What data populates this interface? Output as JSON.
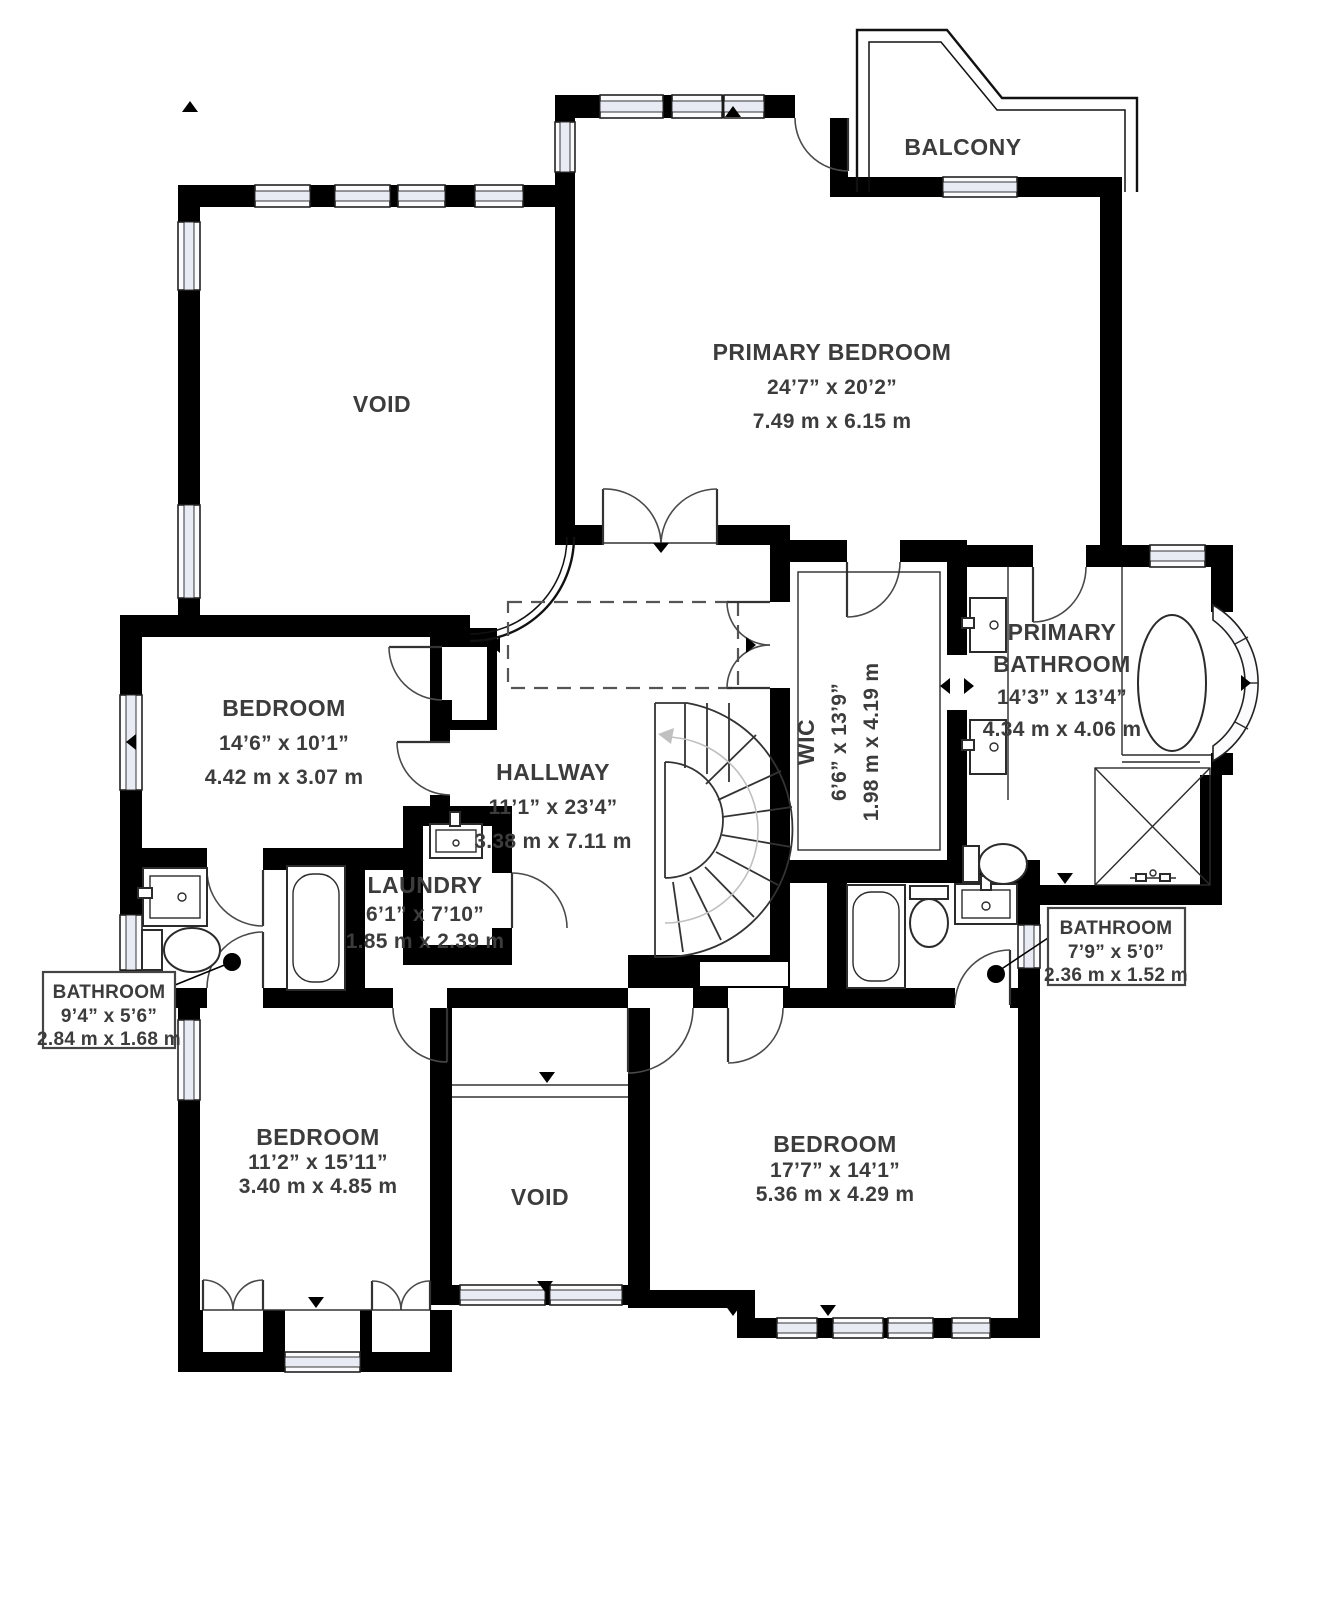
{
  "plan": {
    "type": "floorplan",
    "rooms": [
      {
        "id": "primary_bedroom",
        "name": "PRIMARY BEDROOM",
        "imperial": "24’7” x 20’2”",
        "metric": "7.49 m x 6.15 m"
      },
      {
        "id": "balcony",
        "name": "BALCONY"
      },
      {
        "id": "void_top",
        "name": "VOID"
      },
      {
        "id": "bedroom_left",
        "name": "BEDROOM",
        "imperial": "14’6” x 10’1”",
        "metric": "4.42 m x 3.07 m"
      },
      {
        "id": "hallway",
        "name": "HALLWAY",
        "imperial": "11’1” x 23’4”",
        "metric": "3.38 m x 7.11 m"
      },
      {
        "id": "wic",
        "name": "WIC",
        "imperial": "6’6” x 13’9”",
        "metric": "1.98 m x 4.19 m"
      },
      {
        "id": "primary_bathroom",
        "name_line1": "PRIMARY",
        "name_line2": "BATHROOM",
        "imperial": "14’3” x 13’4”",
        "metric": "4.34 m x 4.06 m"
      },
      {
        "id": "laundry",
        "name": "LAUNDRY",
        "imperial": "6’1” x 7’10”",
        "metric": "1.85 m x 2.39 m"
      },
      {
        "id": "bathroom_left",
        "name": "BATHROOM",
        "imperial": "9’4” x 5’6”",
        "metric": "2.84 m x 1.68 m"
      },
      {
        "id": "bathroom_right",
        "name": "BATHROOM",
        "imperial": "7’9” x 5’0”",
        "metric": "2.36 m x 1.52 m"
      },
      {
        "id": "bedroom_bottom_left",
        "name": "BEDROOM",
        "imperial": "11’2” x 15’11”",
        "metric": "3.40 m x 4.85 m"
      },
      {
        "id": "void_bottom",
        "name": "VOID"
      },
      {
        "id": "bedroom_bottom_right",
        "name": "BEDROOM",
        "imperial": "17’7” x 14’1”",
        "metric": "5.36 m x 4.29 m"
      }
    ],
    "colors": {
      "wall": "#000000",
      "text": "#3c3c3c",
      "window_fill": "#e9ebf4",
      "door_stroke": "#4a4a4a",
      "dash": "#555555",
      "stair_guide": "#c0c0c0",
      "background": "#ffffff"
    }
  }
}
